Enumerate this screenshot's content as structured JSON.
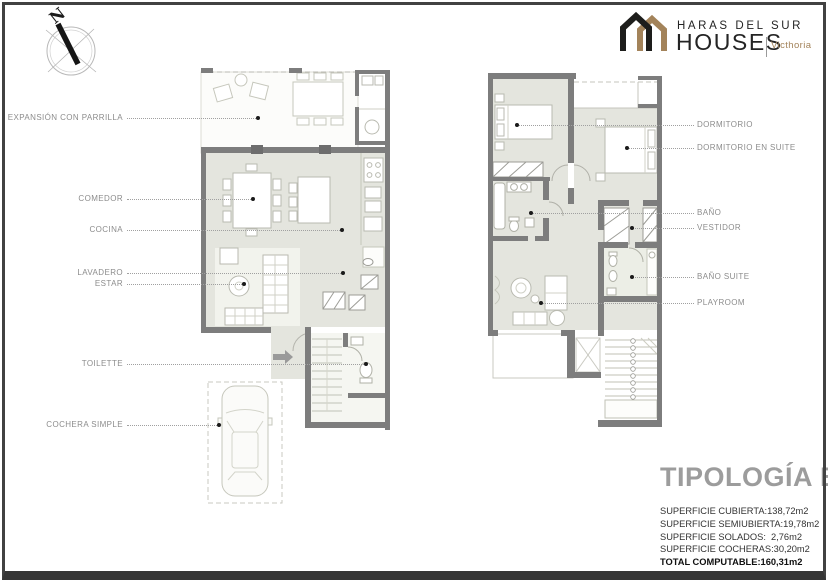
{
  "brand": {
    "line1": "HARAS DEL SUR",
    "line2": "HOUSES",
    "edition": "Victhoria",
    "color_black": "#1d1d1b",
    "color_tan": "#a3835a"
  },
  "compass": {
    "north_label": "N"
  },
  "plan_left": {
    "labels": [
      {
        "text": "EXPANSIÓN CON PARRILLA"
      },
      {
        "text": "COMEDOR"
      },
      {
        "text": "COCINA"
      },
      {
        "text": "LAVADERO"
      },
      {
        "text": "ESTAR"
      },
      {
        "text": "TOILETTE"
      },
      {
        "text": "COCHERA SIMPLE"
      }
    ]
  },
  "plan_right": {
    "labels": [
      {
        "text": "DORMITORIO"
      },
      {
        "text": "DORMITORIO EN SUITE"
      },
      {
        "text": "BAÑO"
      },
      {
        "text": "VESTIDOR"
      },
      {
        "text": "BAÑO SUITE"
      },
      {
        "text": "PLAYROOM"
      }
    ]
  },
  "typology": {
    "title": "TIPOLOGÍA B",
    "rows": [
      {
        "label": "SUPERFICIE CUBIERTA:",
        "value": "138,72m2"
      },
      {
        "label": "SUPERFICIE SEMIUBIERTA:",
        "value": "19,78m2"
      },
      {
        "label": "SUPERFICIE SOLADOS:",
        "value": "2,76m2"
      },
      {
        "label": "SUPERFICIE COCHERAS:",
        "value": "30,20m2"
      }
    ],
    "total": {
      "label": "TOTAL COMPUTABLE:",
      "value": "160,31m2"
    }
  },
  "colors": {
    "wall": "#7d7d7d",
    "floor": "#e4e5de"
  }
}
